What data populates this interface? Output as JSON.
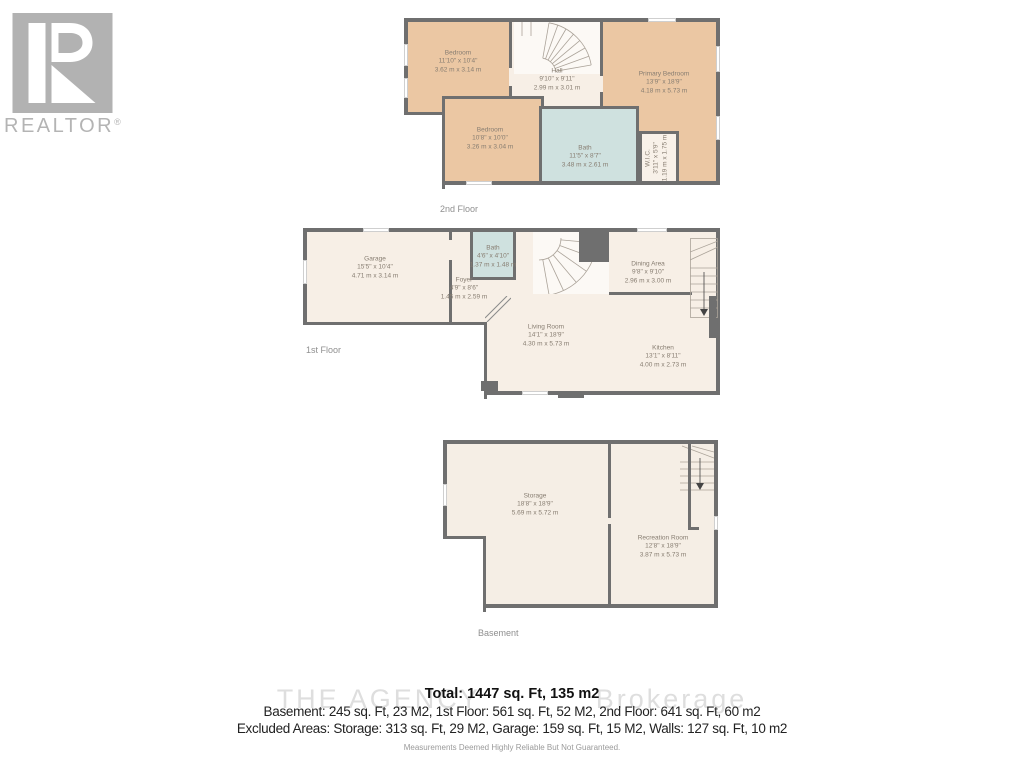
{
  "branding": {
    "logo_text": "REALTOR",
    "registered_mark": "®"
  },
  "colors": {
    "room_peach": "#ebc7a3",
    "room_cream": "#f7efe6",
    "bath_blue": "#cfe1df",
    "wall_gray": "#6f6f6f"
  },
  "floors": {
    "second": {
      "label": "2nd Floor",
      "rooms": {
        "bedroom1": {
          "name": "Bedroom",
          "imperial": "11'10\" x 10'4\"",
          "metric": "3.62 m x 3.14 m"
        },
        "bedroom2": {
          "name": "Bedroom",
          "imperial": "10'8\" x 10'0\"",
          "metric": "3.26 m x 3.04 m"
        },
        "hall": {
          "name": "Hall",
          "imperial": "9'10\" x 9'11\"",
          "metric": "2.99 m x 3.01 m"
        },
        "primary": {
          "name": "Primary Bedroom",
          "imperial": "13'9\" x 18'9\"",
          "metric": "4.18 m x 5.73 m"
        },
        "bath": {
          "name": "Bath",
          "imperial": "11'5\" x 8'7\"",
          "metric": "3.48 m x 2.61 m"
        },
        "wic": {
          "name": "W.I.C.",
          "imperial": "3'11\" x 5'9\"",
          "metric": "1.19 m x 1.75 m"
        }
      }
    },
    "first": {
      "label": "1st Floor",
      "rooms": {
        "garage": {
          "name": "Garage",
          "imperial": "15'5\" x 10'4\"",
          "metric": "4.71 m x 3.14 m"
        },
        "bath": {
          "name": "Bath",
          "imperial": "4'6\" x 4'10\"",
          "metric": "1.37 m x 1.48 m"
        },
        "foyer": {
          "name": "Foyer",
          "imperial": "4'9\" x 8'6\"",
          "metric": "1.45 m x 2.59 m"
        },
        "dining": {
          "name": "Dining Area",
          "imperial": "9'8\" x 9'10\"",
          "metric": "2.96 m x 3.00 m"
        },
        "living": {
          "name": "Living Room",
          "imperial": "14'1\" x 18'9\"",
          "metric": "4.30 m x 5.73 m"
        },
        "kitchen": {
          "name": "Kitchen",
          "imperial": "13'1\" x 8'11\"",
          "metric": "4.00 m x 2.73 m"
        }
      }
    },
    "basement": {
      "label": "Basement",
      "rooms": {
        "storage": {
          "name": "Storage",
          "imperial": "18'8\" x 18'9\"",
          "metric": "5.69 m x 5.72 m"
        },
        "recreation": {
          "name": "Recreation Room",
          "imperial": "12'8\" x 18'9\"",
          "metric": "3.87 m x 5.73 m"
        }
      }
    }
  },
  "footer": {
    "watermark_left": "THE AGENCY",
    "watermark_right": "Brokerage",
    "total": "Total: 1447 sq. Ft, 135 m2",
    "areas_line": "Basement: 245 sq. Ft, 23 M2, 1st Floor: 561 sq. Ft, 52 M2, 2nd Floor: 641 sq. Ft, 60 m2",
    "excluded_line": "Excluded Areas: Storage: 313 sq. Ft, 29 M2, Garage: 159 sq. Ft, 15 M2, Walls: 127 sq. Ft, 10 m2",
    "disclaimer": "Measurements Deemed Highly Reliable But Not Guaranteed."
  }
}
